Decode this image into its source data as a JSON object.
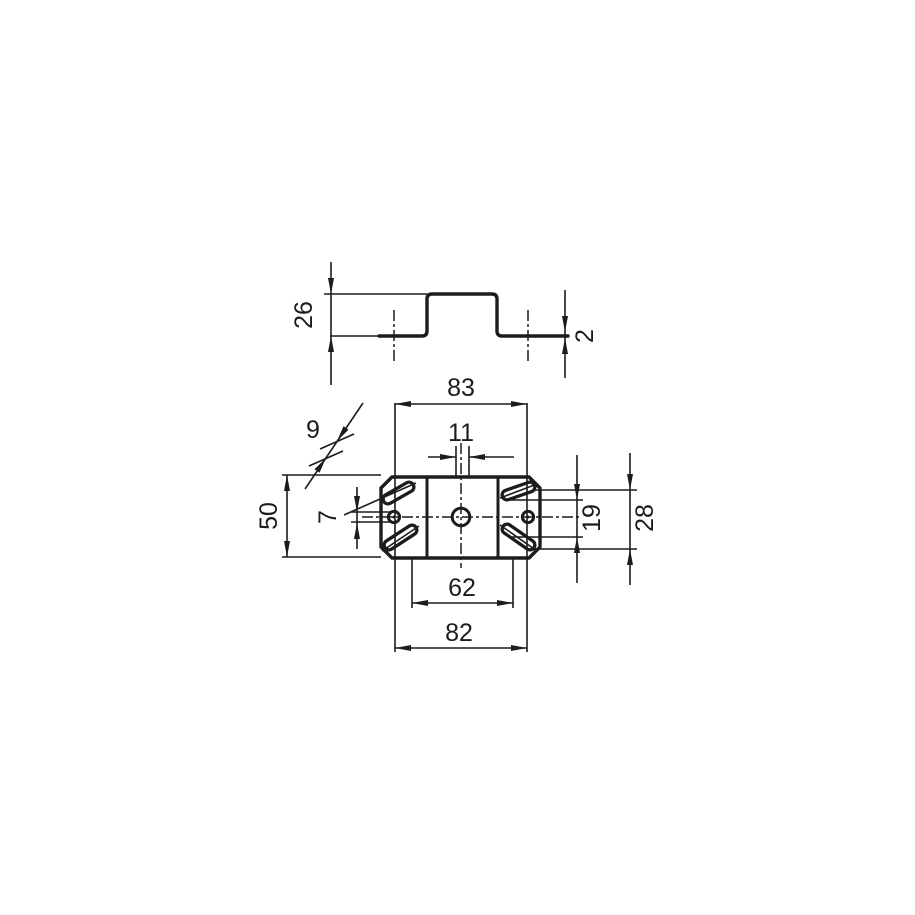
{
  "drawing": {
    "kind": "mounting-bracket-dimension-drawing",
    "colors": {
      "background": "#ffffff",
      "line": "#1c1c1c"
    },
    "views": {
      "profile": {
        "label": "side-profile",
        "dims": {
          "height": "26",
          "material_thickness": "2"
        }
      },
      "plan": {
        "label": "top-plan",
        "dims": {
          "slot_span_outer": "83",
          "center_hole_dia": "11",
          "slot_width": "9",
          "small_hole_dia": "7",
          "bracket_height": "50",
          "slot_span_inner": "62",
          "overall_width": "82",
          "slot_offset_inner": "19",
          "slot_offset_outer": "28"
        }
      }
    }
  }
}
